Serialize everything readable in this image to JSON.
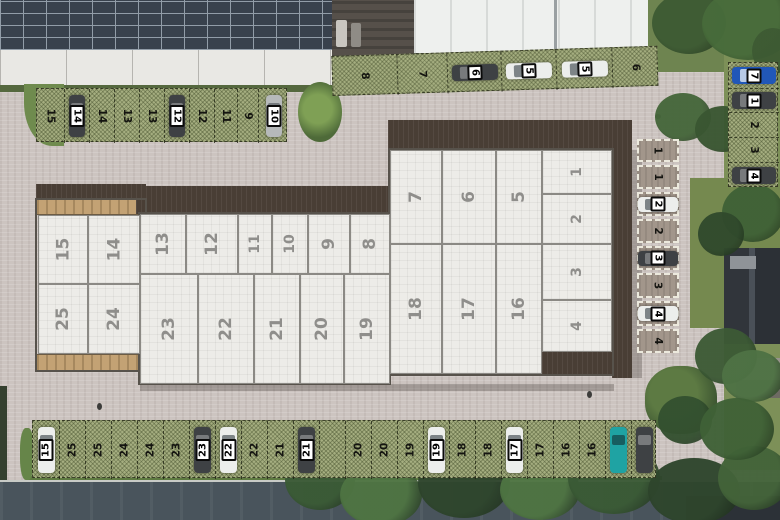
{
  "scene_label": "Aerial site plan of industrial units with numbered parking",
  "units": {
    "left_block_top": [
      "15",
      "14"
    ],
    "left_block_bottom": [
      "25",
      "24"
    ],
    "middle_top": [
      "13",
      "12",
      "11",
      "10",
      "9",
      "8"
    ],
    "middle_bottom": [
      "23",
      "22",
      "21",
      "20",
      "19"
    ],
    "right_top": [
      "7",
      "6",
      "5"
    ],
    "right_bottom": [
      "18",
      "17",
      "16"
    ],
    "right_end_column": [
      "1",
      "2",
      "3",
      "4"
    ]
  },
  "parking": {
    "top_left_row": [
      {
        "label": "15"
      },
      {
        "label": "14",
        "car": "darkgray"
      },
      {
        "label": "14"
      },
      {
        "label": "13"
      },
      {
        "label": "13"
      },
      {
        "label": "12",
        "car": "darkgray"
      },
      {
        "label": "12"
      },
      {
        "label": "11"
      },
      {
        "label": "9"
      },
      {
        "label": "10",
        "car": "silver"
      }
    ],
    "top_right_row": [
      {
        "label": "8"
      },
      {
        "label": "7"
      },
      {
        "label": "6",
        "car": "darkgray"
      },
      {
        "label": "5",
        "car": "white"
      },
      {
        "label": "5",
        "car": "white"
      },
      {
        "label": "6"
      }
    ],
    "right_column": [
      {
        "label": "7",
        "car": "blue"
      },
      {
        "label": "1",
        "car": "darkgray"
      },
      {
        "label": "2"
      },
      {
        "label": "3"
      },
      {
        "label": "4",
        "car": "darkgray"
      }
    ],
    "building_side_spaces": [
      {
        "label": "1"
      },
      {
        "label": "1"
      },
      {
        "label": "2",
        "car": "white"
      },
      {
        "label": "2"
      },
      {
        "label": "3",
        "car": "darkgray"
      },
      {
        "label": "3"
      },
      {
        "label": "4",
        "car": "white"
      },
      {
        "label": "4"
      }
    ],
    "bottom_row": [
      {
        "label": "15",
        "car": "white"
      },
      {
        "label": "25"
      },
      {
        "label": "25"
      },
      {
        "label": "24"
      },
      {
        "label": "24"
      },
      {
        "label": "23"
      },
      {
        "label": "23",
        "car": "darkgray"
      },
      {
        "label": "22",
        "car": "white"
      },
      {
        "label": "22"
      },
      {
        "label": "21"
      },
      {
        "label": "21",
        "car": "darkgray"
      },
      {
        "label": ""
      },
      {
        "label": "20"
      },
      {
        "label": "20"
      },
      {
        "label": "19"
      },
      {
        "label": "19",
        "car": "white"
      },
      {
        "label": "18"
      },
      {
        "label": "18"
      },
      {
        "label": "17",
        "car": "white"
      },
      {
        "label": "17"
      },
      {
        "label": "16"
      },
      {
        "label": "16"
      },
      {
        "label": "",
        "car": "teal"
      },
      {
        "label": "",
        "car": "darkgray"
      }
    ]
  },
  "car_colors": {
    "darkgray": "#3e4144",
    "white": "#eceeec",
    "silver": "#b6b9ba",
    "blue": "#2157b8",
    "teal": "#1fa3a3"
  }
}
